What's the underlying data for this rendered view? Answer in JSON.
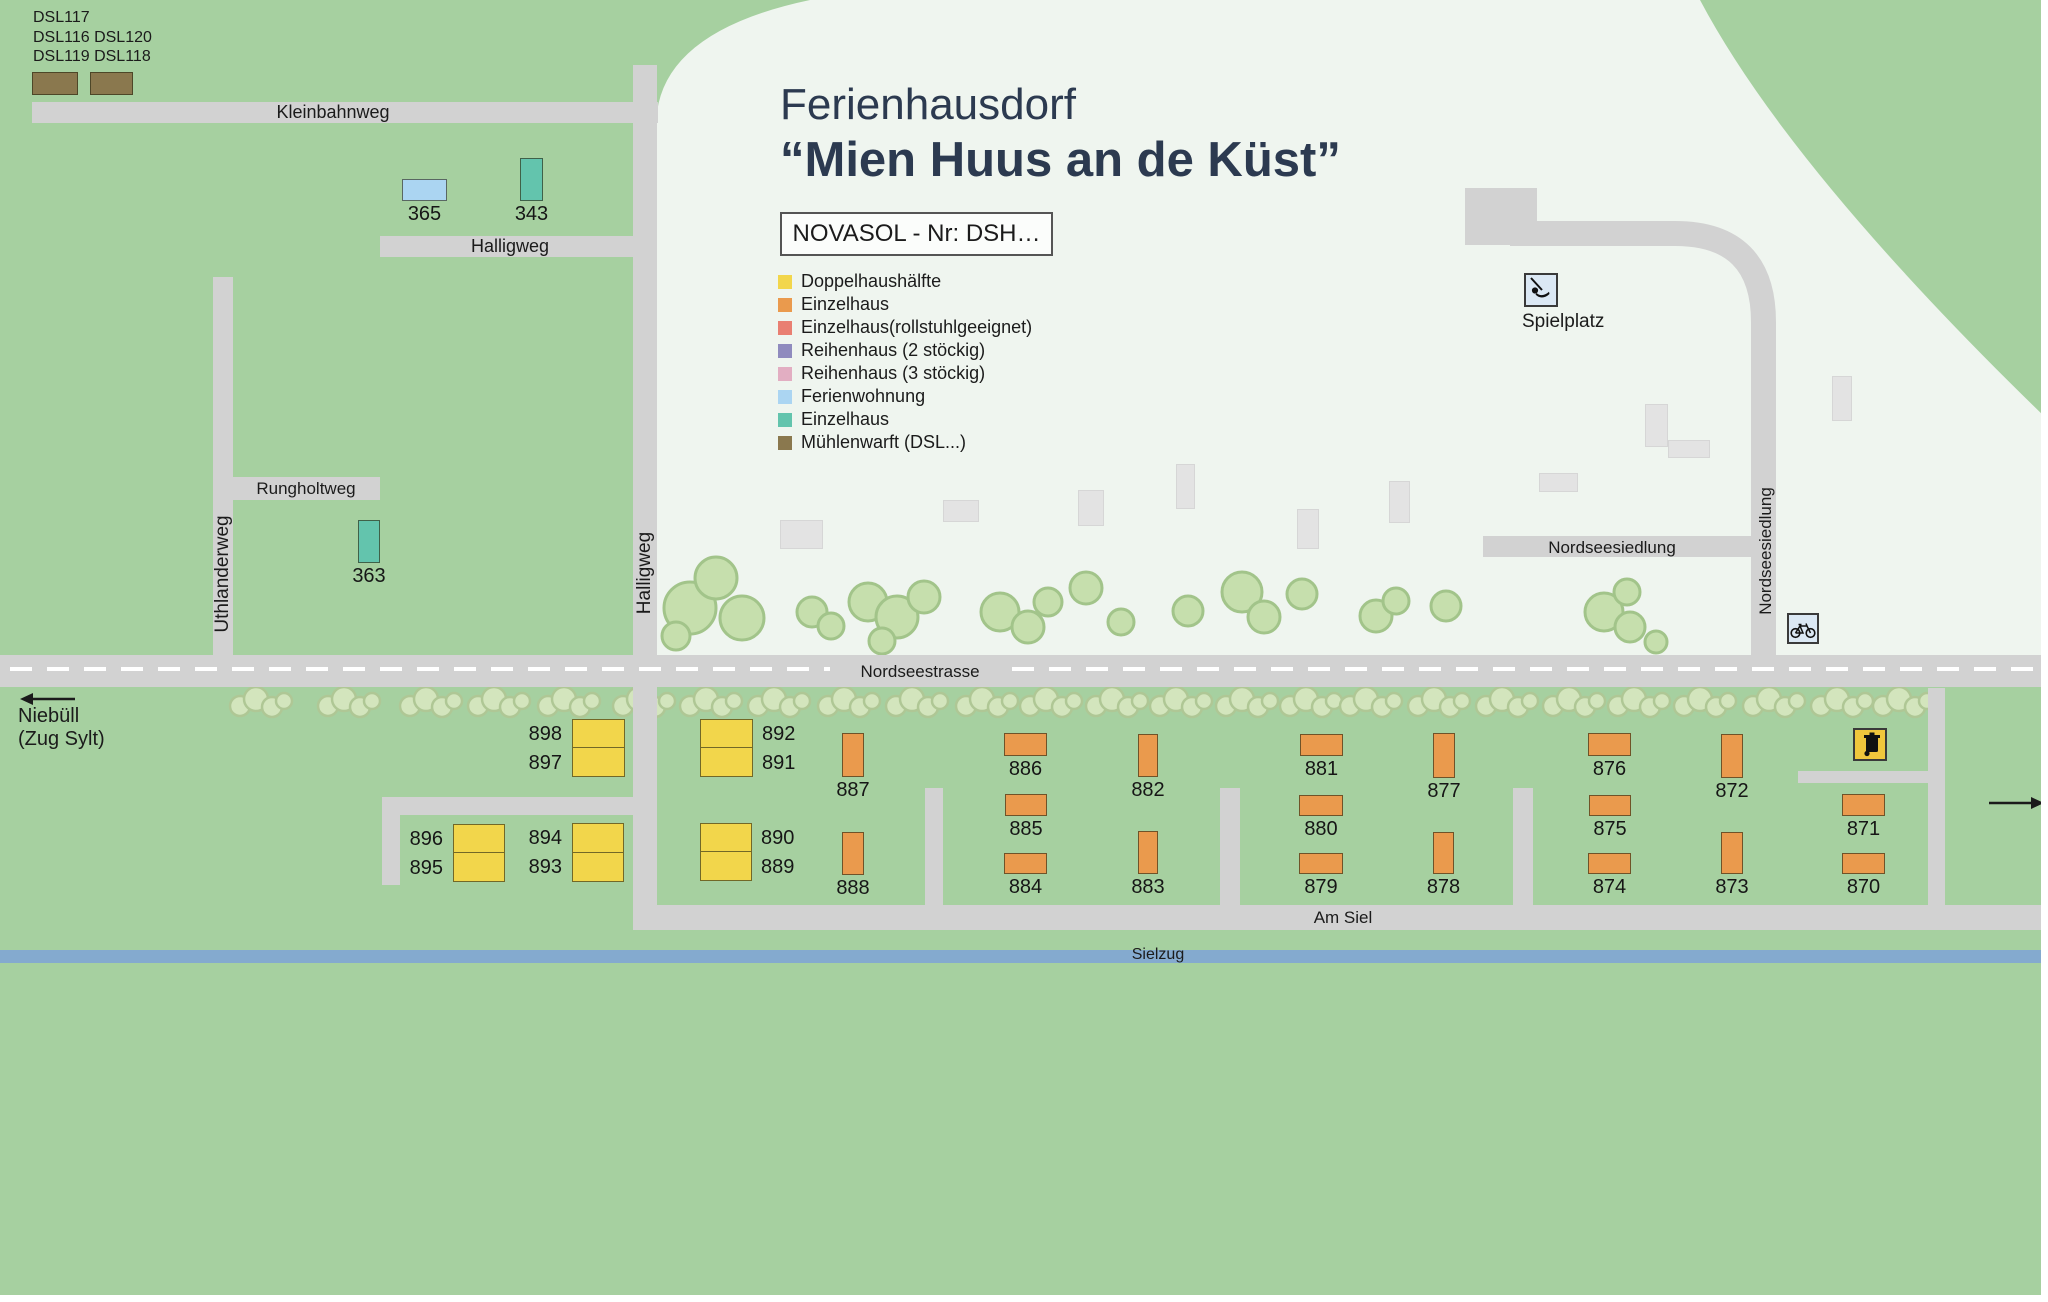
{
  "map_title": {
    "line1": "Ferienhausdorf",
    "line2": "“Mien Huus an de Küst”"
  },
  "novasol": {
    "label": "NOVASOL - Nr: DSH…"
  },
  "dsl_area": {
    "line1": "DSL117",
    "line2": "DSL116 DSL120",
    "line3": "DSL119 DSL118"
  },
  "legend": {
    "items": [
      {
        "label": "Doppelhaushälfte",
        "color": "#F2D64B"
      },
      {
        "label": "Einzelhaus",
        "color": "#EA9A4D"
      },
      {
        "label": "Einzelhaus(rollstuhlgeeignet)",
        "color": "#E97F72"
      },
      {
        "label": "Reihenhaus (2 stöckig)",
        "color": "#8F8BBE"
      },
      {
        "label": "Reihenhaus (3 stöckig)",
        "color": "#E2AEC2"
      },
      {
        "label": "Ferienwohnung",
        "color": "#ABD5F2"
      },
      {
        "label": "Einzelhaus",
        "color": "#63C4AD"
      },
      {
        "label": "Mühlenwarft (DSL...)",
        "color": "#8A784E"
      }
    ]
  },
  "labels": {
    "kleinbahnweg": "Kleinbahnweg",
    "halligweg_h": "Halligweg",
    "halligweg_v": "Halligweg",
    "rungholtweg": "Rungholtweg",
    "uthlanderweg": "Uthlanderweg",
    "nordseesiedlung_h": "Nordseesiedlung",
    "nordseesiedlung_v": "Nordseesiedlung",
    "nordseestrasse": "Nordseestrasse",
    "am_siel": "Am Siel",
    "sielzug": "Sielzug",
    "spielplatz": "Spielplatz",
    "niebuell_line1": "Niebüll",
    "niebuell_line2": "(Zug Sylt)"
  },
  "colors": {
    "green": "#A6D0A0",
    "light_area": "#EFF5EF",
    "road": "#D2D2D2",
    "water": "#84AACF",
    "building": "#E3E3E3",
    "tree_big_fill": "#C6DFAD",
    "tree_big_stroke": "#A2C48A",
    "tree_small_fill": "#D3E5BD",
    "tree_small_stroke": "#AFC795",
    "title_text": "#2C3A50",
    "house_types": {
      "dh": "#F2D64B",
      "eo": "#EA9A4D",
      "et": "#63C4AD",
      "fw": "#ABD5F2",
      "mw": "#8A784E"
    }
  },
  "houses": [
    {
      "n": "",
      "t": "mw",
      "x": 32,
      "y": 72,
      "w": 46,
      "h": 23
    },
    {
      "n": "",
      "t": "mw",
      "x": 90,
      "y": 72,
      "w": 43,
      "h": 23
    },
    {
      "n": "365",
      "t": "fw",
      "x": 402,
      "y": 179,
      "w": 45,
      "h": 22
    },
    {
      "n": "343",
      "t": "et",
      "x": 520,
      "y": 158,
      "w": 23,
      "h": 43
    },
    {
      "n": "363",
      "t": "et",
      "x": 358,
      "y": 520,
      "w": 22,
      "h": 43
    },
    {
      "n": "887",
      "t": "eo",
      "x": 842,
      "y": 733,
      "w": 22,
      "h": 44
    },
    {
      "n": "888",
      "t": "eo",
      "x": 842,
      "y": 832,
      "w": 22,
      "h": 43
    },
    {
      "n": "886",
      "t": "eo",
      "x": 1004,
      "y": 733,
      "w": 43,
      "h": 23
    },
    {
      "n": "885",
      "t": "eo",
      "x": 1005,
      "y": 794,
      "w": 42,
      "h": 22
    },
    {
      "n": "884",
      "t": "eo",
      "x": 1004,
      "y": 853,
      "w": 43,
      "h": 21
    },
    {
      "n": "882",
      "t": "eo",
      "x": 1138,
      "y": 734,
      "w": 20,
      "h": 43
    },
    {
      "n": "883",
      "t": "eo",
      "x": 1138,
      "y": 831,
      "w": 20,
      "h": 43
    },
    {
      "n": "881",
      "t": "eo",
      "x": 1300,
      "y": 734,
      "w": 43,
      "h": 22
    },
    {
      "n": "880",
      "t": "eo",
      "x": 1299,
      "y": 795,
      "w": 44,
      "h": 21
    },
    {
      "n": "879",
      "t": "eo",
      "x": 1299,
      "y": 853,
      "w": 44,
      "h": 21
    },
    {
      "n": "877",
      "t": "eo",
      "x": 1433,
      "y": 733,
      "w": 22,
      "h": 45
    },
    {
      "n": "878",
      "t": "eo",
      "x": 1433,
      "y": 832,
      "w": 21,
      "h": 42
    },
    {
      "n": "876",
      "t": "eo",
      "x": 1588,
      "y": 733,
      "w": 43,
      "h": 23
    },
    {
      "n": "875",
      "t": "eo",
      "x": 1589,
      "y": 795,
      "w": 42,
      "h": 21
    },
    {
      "n": "874",
      "t": "eo",
      "x": 1588,
      "y": 853,
      "w": 43,
      "h": 21
    },
    {
      "n": "872",
      "t": "eo",
      "x": 1721,
      "y": 734,
      "w": 22,
      "h": 44
    },
    {
      "n": "873",
      "t": "eo",
      "x": 1721,
      "y": 832,
      "w": 22,
      "h": 42
    },
    {
      "n": "871",
      "t": "eo",
      "x": 1842,
      "y": 794,
      "w": 43,
      "h": 22
    },
    {
      "n": "870",
      "t": "eo",
      "x": 1842,
      "y": 853,
      "w": 43,
      "h": 21
    }
  ],
  "double_houses": [
    {
      "a": "898",
      "b": "897",
      "x": 572,
      "y": 719,
      "w": 53,
      "h": 58,
      "side": "left"
    },
    {
      "a": "892",
      "b": "891",
      "x": 700,
      "y": 719,
      "w": 53,
      "h": 58,
      "side": "right"
    },
    {
      "a": "896",
      "b": "895",
      "x": 453,
      "y": 824,
      "w": 52,
      "h": 58,
      "side": "left"
    },
    {
      "a": "894",
      "b": "893",
      "x": 572,
      "y": 823,
      "w": 52,
      "h": 59,
      "side": "left"
    },
    {
      "a": "890",
      "b": "889",
      "x": 700,
      "y": 823,
      "w": 52,
      "h": 58,
      "side": "right"
    }
  ],
  "buildings": [
    [
      780,
      520,
      43,
      29
    ],
    [
      943,
      500,
      36,
      22
    ],
    [
      1078,
      490,
      26,
      36
    ],
    [
      1176,
      464,
      19,
      45
    ],
    [
      1297,
      509,
      22,
      40
    ],
    [
      1389,
      481,
      21,
      42
    ],
    [
      1539,
      473,
      39,
      19
    ],
    [
      1645,
      404,
      23,
      43
    ],
    [
      1668,
      440,
      42,
      18
    ],
    [
      1832,
      376,
      20,
      45
    ]
  ],
  "roads": [
    [
      32,
      102,
      626,
      21
    ],
    [
      633,
      65,
      24,
      865
    ],
    [
      380,
      236,
      277,
      21
    ],
    [
      233,
      477,
      147,
      23
    ],
    [
      213,
      277,
      20,
      378
    ],
    [
      1483,
      536,
      274,
      21
    ],
    [
      1465,
      188,
      72,
      57
    ],
    [
      0,
      655,
      2048,
      32
    ],
    [
      633,
      905,
      1415,
      25
    ],
    [
      382,
      797,
      275,
      18
    ],
    [
      382,
      797,
      18,
      88
    ],
    [
      925,
      788,
      18,
      117
    ],
    [
      1220,
      788,
      20,
      117
    ],
    [
      1513,
      788,
      20,
      117
    ],
    [
      1928,
      688,
      17,
      217
    ],
    [
      1798,
      771,
      130,
      12
    ]
  ],
  "trees_big": [
    [
      690,
      608,
      26
    ],
    [
      716,
      578,
      21
    ],
    [
      742,
      618,
      22
    ],
    [
      676,
      636,
      14
    ],
    [
      812,
      612,
      15
    ],
    [
      831,
      626,
      13
    ],
    [
      868,
      602,
      19
    ],
    [
      897,
      617,
      21
    ],
    [
      924,
      597,
      16
    ],
    [
      882,
      641,
      13
    ],
    [
      1000,
      612,
      19
    ],
    [
      1028,
      627,
      16
    ],
    [
      1048,
      602,
      14
    ],
    [
      1086,
      588,
      16
    ],
    [
      1121,
      622,
      13
    ],
    [
      1188,
      611,
      15
    ],
    [
      1242,
      592,
      20
    ],
    [
      1264,
      617,
      16
    ],
    [
      1302,
      594,
      15
    ],
    [
      1376,
      616,
      16
    ],
    [
      1396,
      601,
      13
    ],
    [
      1446,
      606,
      15
    ],
    [
      1604,
      612,
      19
    ],
    [
      1630,
      627,
      15
    ],
    [
      1627,
      592,
      13
    ],
    [
      1656,
      642,
      11
    ]
  ],
  "tree_row_x": [
    262,
    350,
    432,
    500,
    570,
    645,
    712,
    780,
    850,
    918,
    988,
    1052,
    1118,
    1182,
    1248,
    1312,
    1372,
    1440,
    1508,
    1575,
    1640,
    1706,
    1775,
    1843,
    1905
  ]
}
